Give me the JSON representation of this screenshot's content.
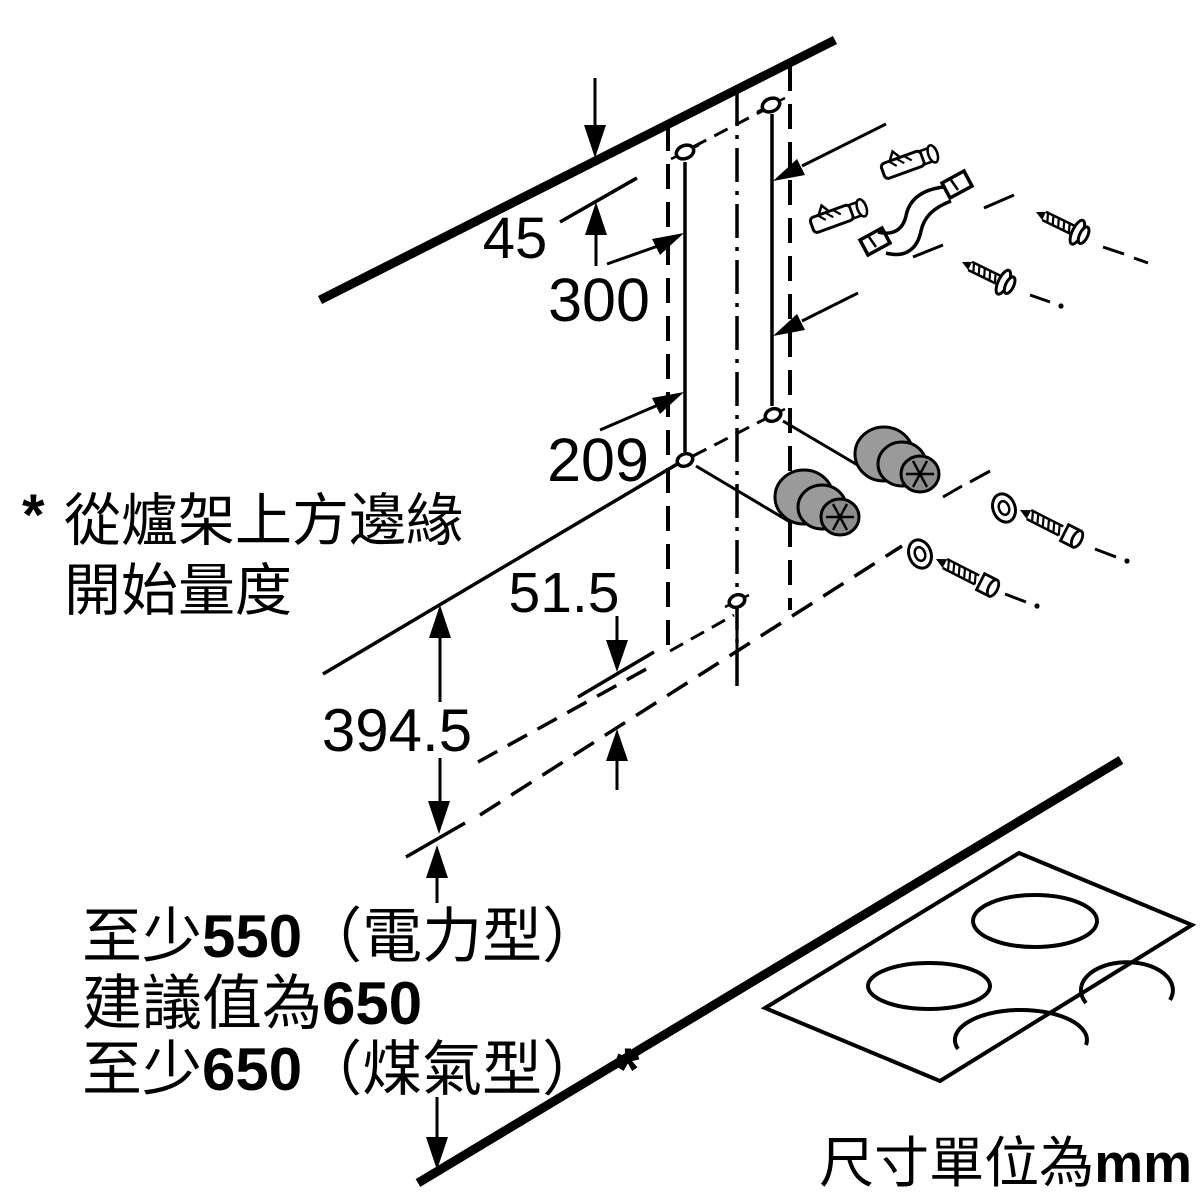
{
  "diagram": {
    "dimensions": {
      "ceiling_offset": "45",
      "hole_span": "300",
      "hole_height": "209",
      "lower_gap": "51.5",
      "lower_section_height": "394.5"
    },
    "note": {
      "marker": "*",
      "line1": "從爐架上方邊緣",
      "line2": "開始量度"
    },
    "clearance": {
      "line1": {
        "prefix": "至少",
        "value": "550",
        "suffix": "（電力型）"
      },
      "line2": {
        "prefix": "建議值為",
        "value": "650"
      },
      "line3": {
        "prefix": "至少",
        "value": "650",
        "suffix": "（煤氣型）",
        "marker": "*"
      }
    },
    "units": {
      "label": "尺寸單位為",
      "unit": "mm"
    },
    "colors": {
      "line": "#000000",
      "spacer_gray": "#9a9a9a",
      "spacer_face": "#8c8c8c",
      "background": "#ffffff"
    }
  }
}
